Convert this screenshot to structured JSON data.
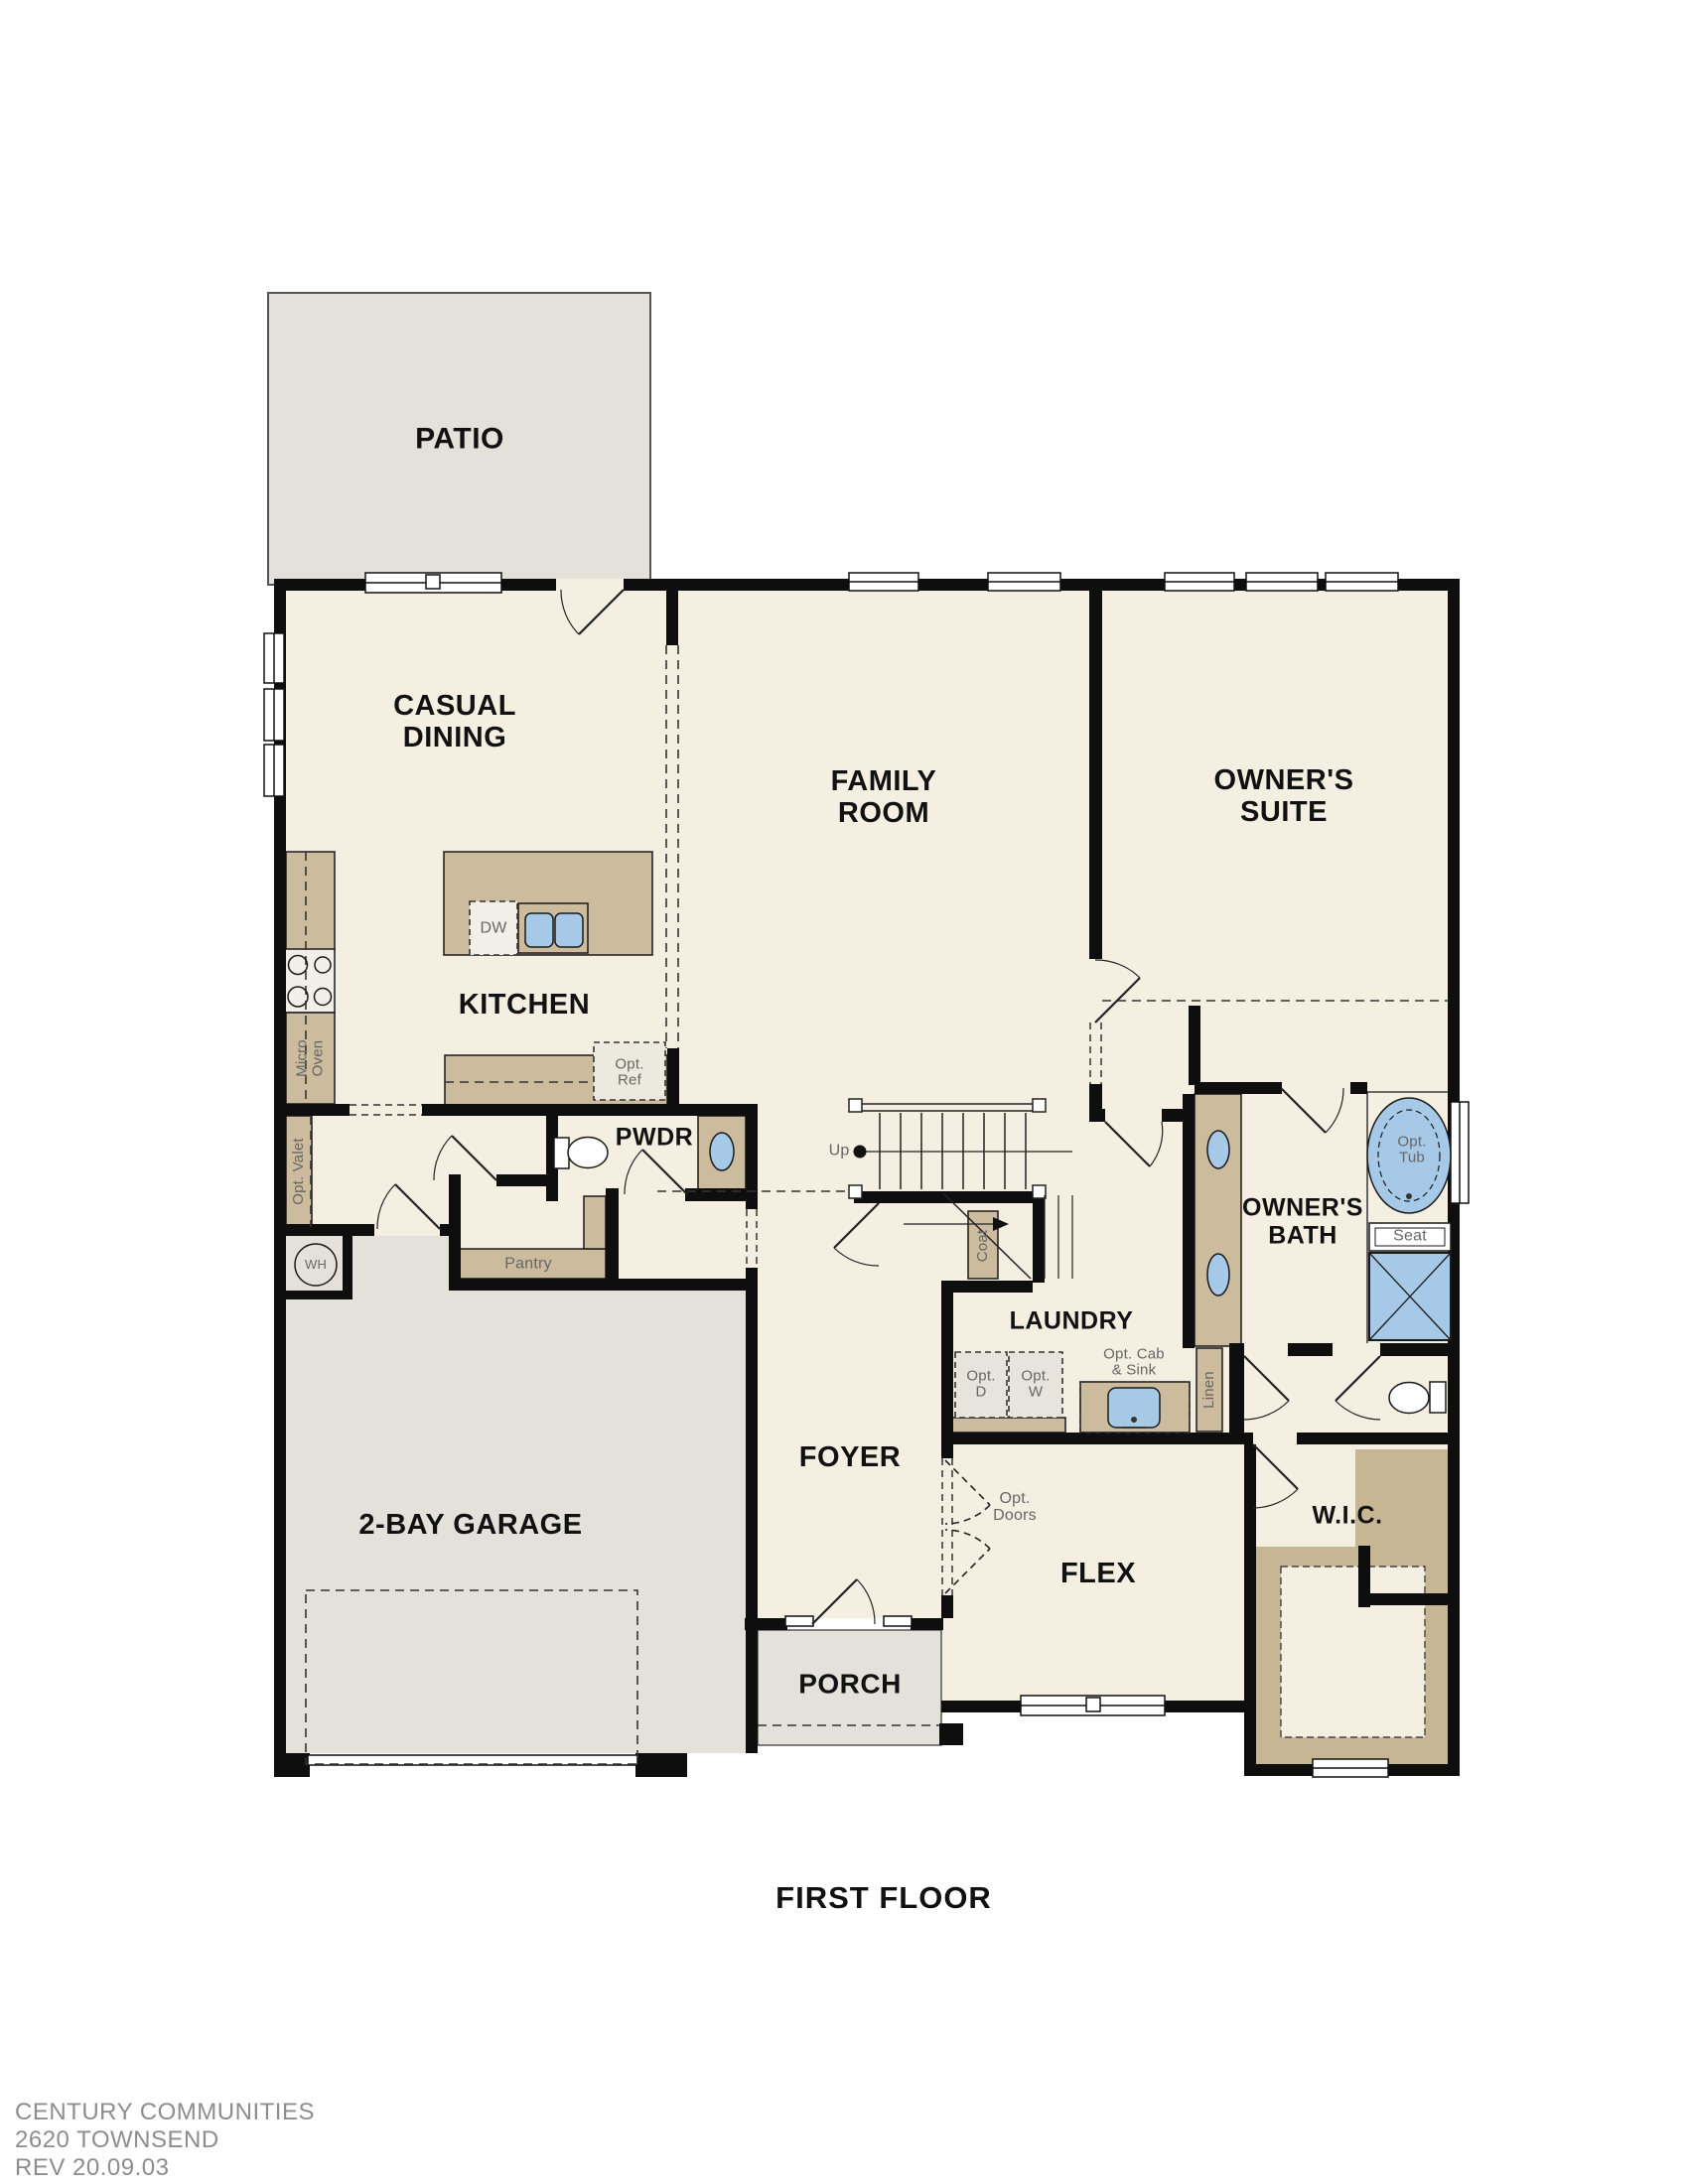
{
  "title": "FIRST FLOOR",
  "footer": {
    "brand": "CENTURY COMMUNITIES",
    "plan_name": "2620 TOWNSEND",
    "revision": "REV 20.09.03"
  },
  "rooms": {
    "patio": "PATIO",
    "casual_dining": "CASUAL\nDINING",
    "kitchen": "KITCHEN",
    "family_room": "FAMILY\nROOM",
    "owners_suite": "OWNER'S\nSUITE",
    "pwdr": "PWDR",
    "owners_bath": "OWNER'S\nBATH",
    "laundry": "LAUNDRY",
    "foyer": "FOYER",
    "garage": "2-BAY GARAGE",
    "flex": "FLEX",
    "wic": "W.I.C.",
    "porch": "PORCH"
  },
  "fixtures": {
    "dw": "DW",
    "opt_ref": "Opt.\nRef",
    "micro_oven": "Micro\nOven",
    "opt_valet": "Opt. Valet",
    "wh": "WH",
    "pantry": "Pantry",
    "up": "Up",
    "coat": "Coat",
    "opt_tub": "Opt.\nTub",
    "seat": "Seat",
    "opt_d": "Opt.\nD",
    "opt_w": "Opt.\nW",
    "opt_cab_sink": "Opt. Cab\n& Sink",
    "linen": "Linen",
    "opt_doors": "Opt.\nDoors"
  },
  "colors": {
    "wall": "#0e0e0e",
    "floor": "#f5efe2",
    "concrete": "#e4e1db",
    "cabinet": "#ccbc9d",
    "fixture_blue": "#a5c9e7",
    "room_label": "#111111",
    "small_label": "#666666",
    "footer_text": "#8d8d8d"
  }
}
